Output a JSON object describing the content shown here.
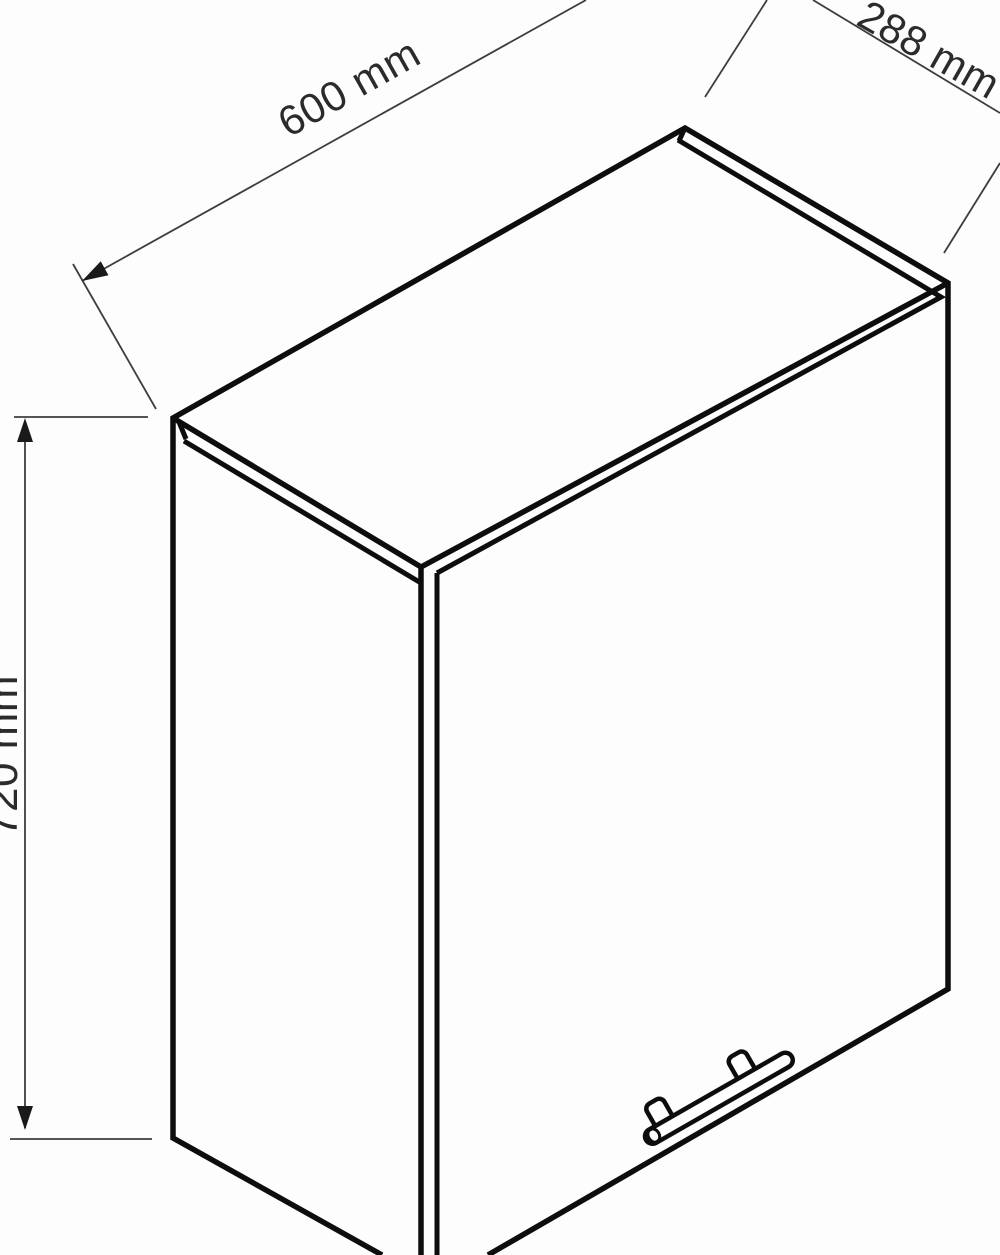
{
  "drawing": {
    "labels": {
      "width": "600 mm",
      "depth": "288 mm",
      "height": "720 mm"
    },
    "colors": {
      "background": "#fdfdfd",
      "outline": "#0d0d0d",
      "dimension_line": "#3d3d3d",
      "arrow_fill": "#1a1a1a",
      "text": "#2b2b2b"
    }
  }
}
